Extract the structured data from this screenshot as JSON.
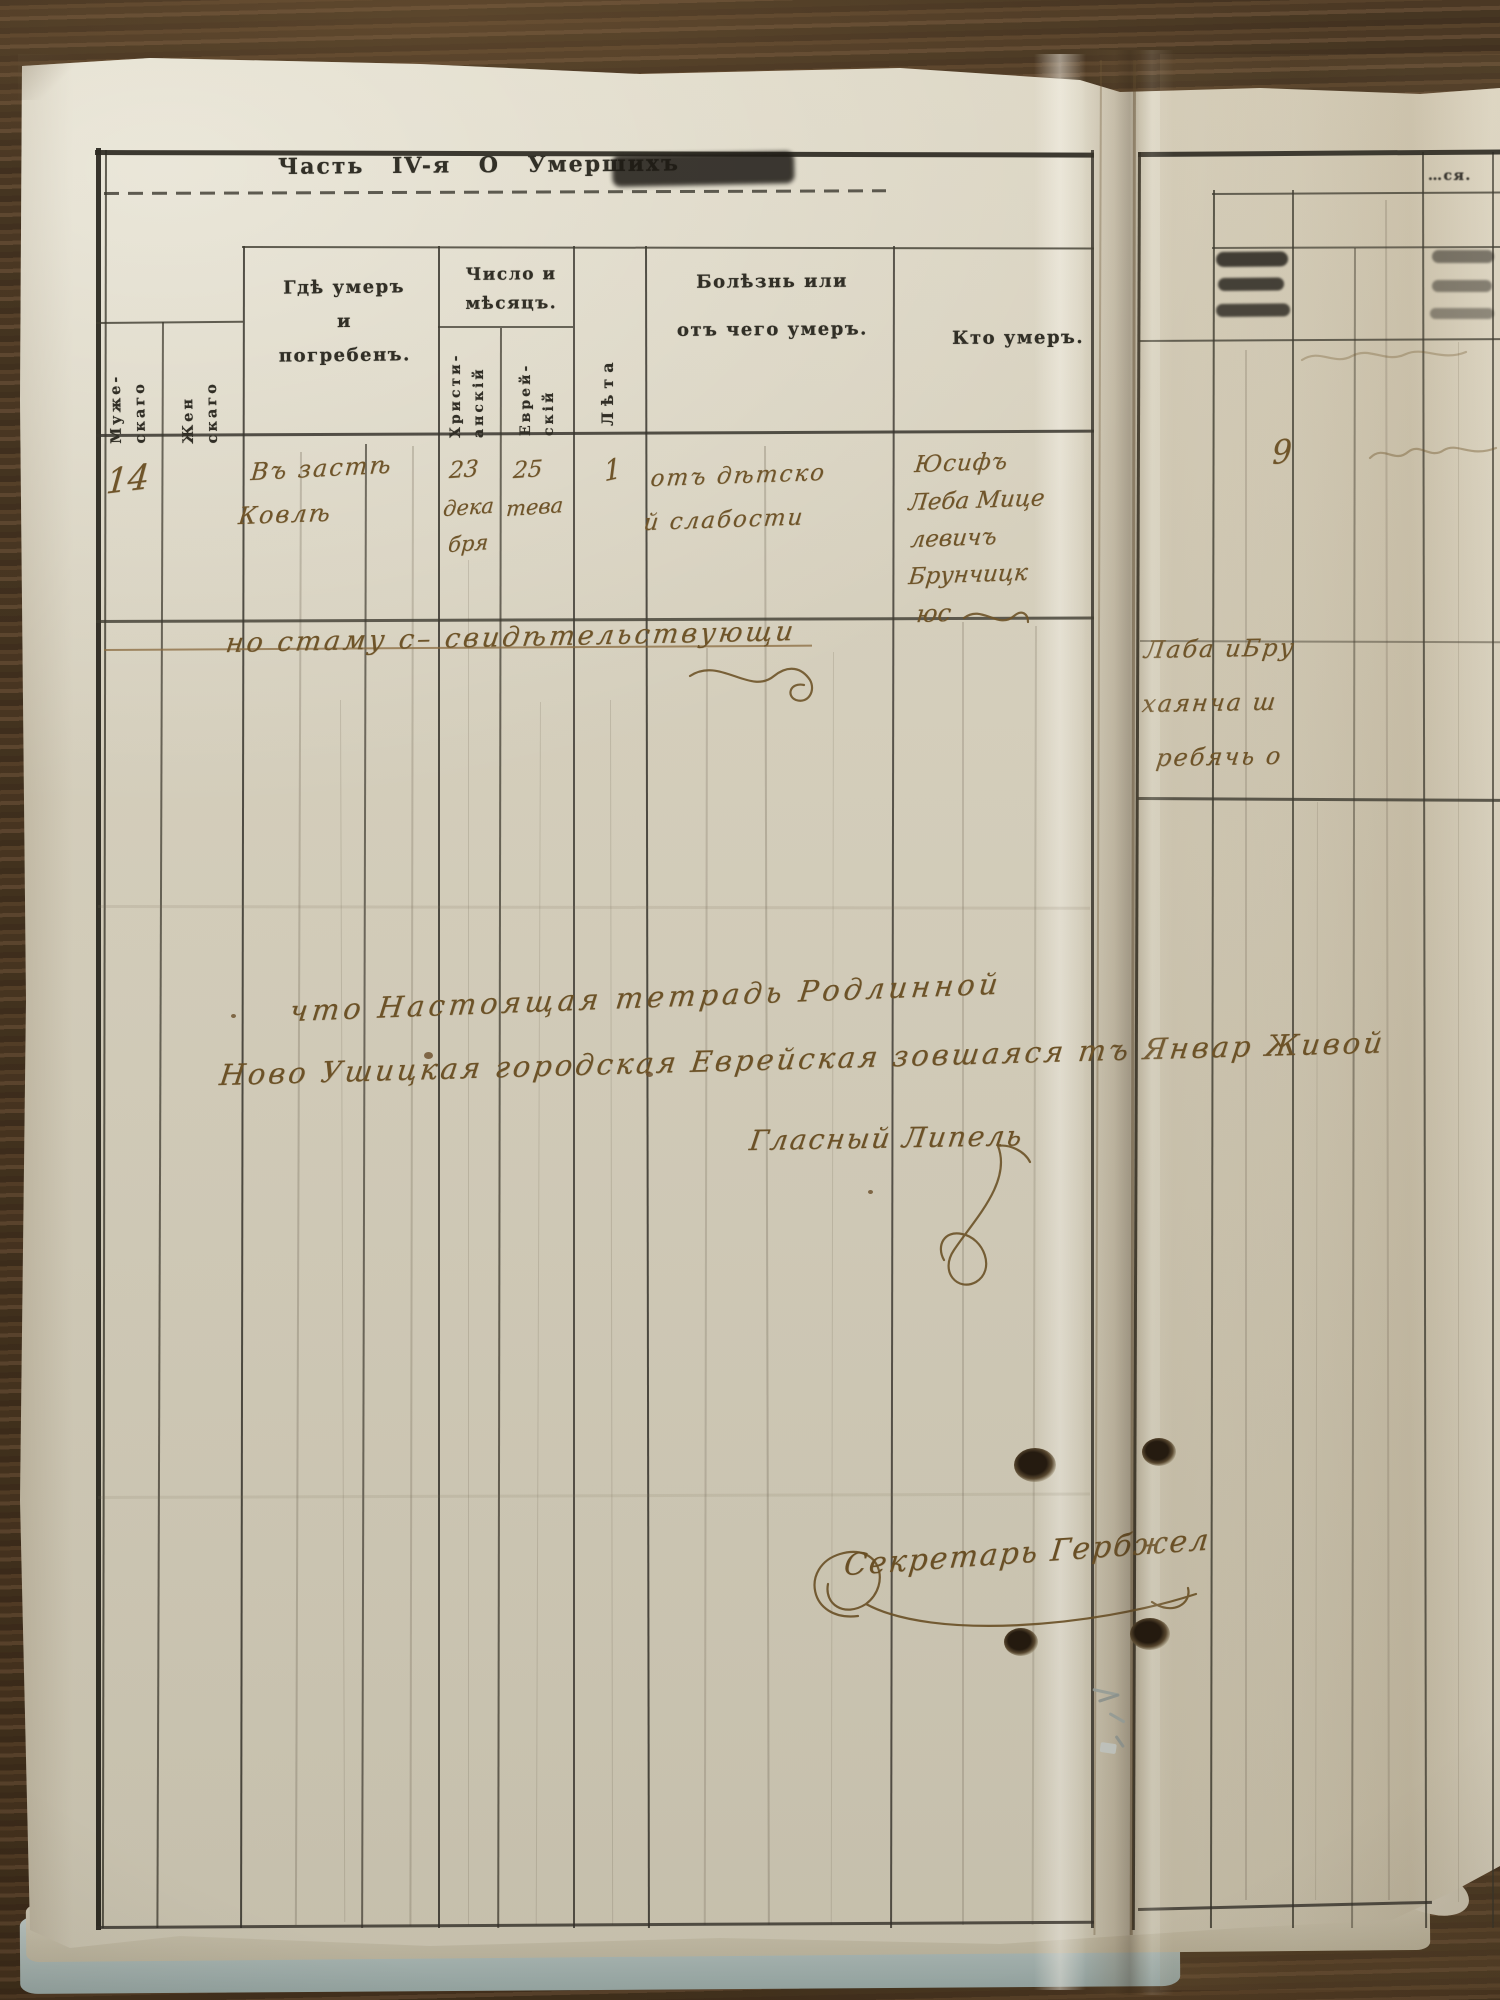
{
  "document": {
    "title": "Часть IV-я О Умершихъ",
    "columns": {
      "male": [
        "Муже-",
        "скаго"
      ],
      "female": [
        "Жен",
        "скаго"
      ],
      "where": [
        "Гдѣ умеръ",
        "и",
        "погребенъ."
      ],
      "date_group": [
        "Число и",
        "мѣсяцъ."
      ],
      "date_christian": [
        "Христи-",
        "анскій"
      ],
      "date_jewish": [
        "Еврей-",
        "скій"
      ],
      "age": "Лѣта",
      "cause": [
        "Болѣзнь или",
        "отъ чего умеръ."
      ],
      "who": "Кто умеръ."
    },
    "right_page_fragment": "…ся."
  },
  "entry": {
    "number": "14",
    "place": [
      "Въ застѣ",
      "Ковлѣ"
    ],
    "date_christian": [
      "23",
      "дека",
      "бря"
    ],
    "date_jewish": [
      "25",
      "тева"
    ],
    "age": "1",
    "cause": [
      "отъ дѣтско",
      "й слабости"
    ],
    "deceased": [
      "Юсифъ",
      "Леба Мице",
      "левичъ",
      "Брунчицк",
      "юс"
    ]
  },
  "handwritten": {
    "mid_note": "но стаму с– свидѣтельствующи",
    "right_note": [
      "Лаба иБру",
      "хаянча ш",
      "ребячь о"
    ],
    "certification_1": "что Настоящая тетрадь Родлинной",
    "certification_2": "Ново Ушицкая городская Еврейская зовшаяся тъ Январ Живой",
    "official_line": "Гласный Липель",
    "secretary": "Секретарь Гербжел",
    "right_page_number": "9"
  },
  "colors": {
    "paper": "#d8d2c0",
    "printed_ink": "#2c2a24",
    "handwriting_ink": "#6d5226",
    "wood": "#4a3421"
  }
}
